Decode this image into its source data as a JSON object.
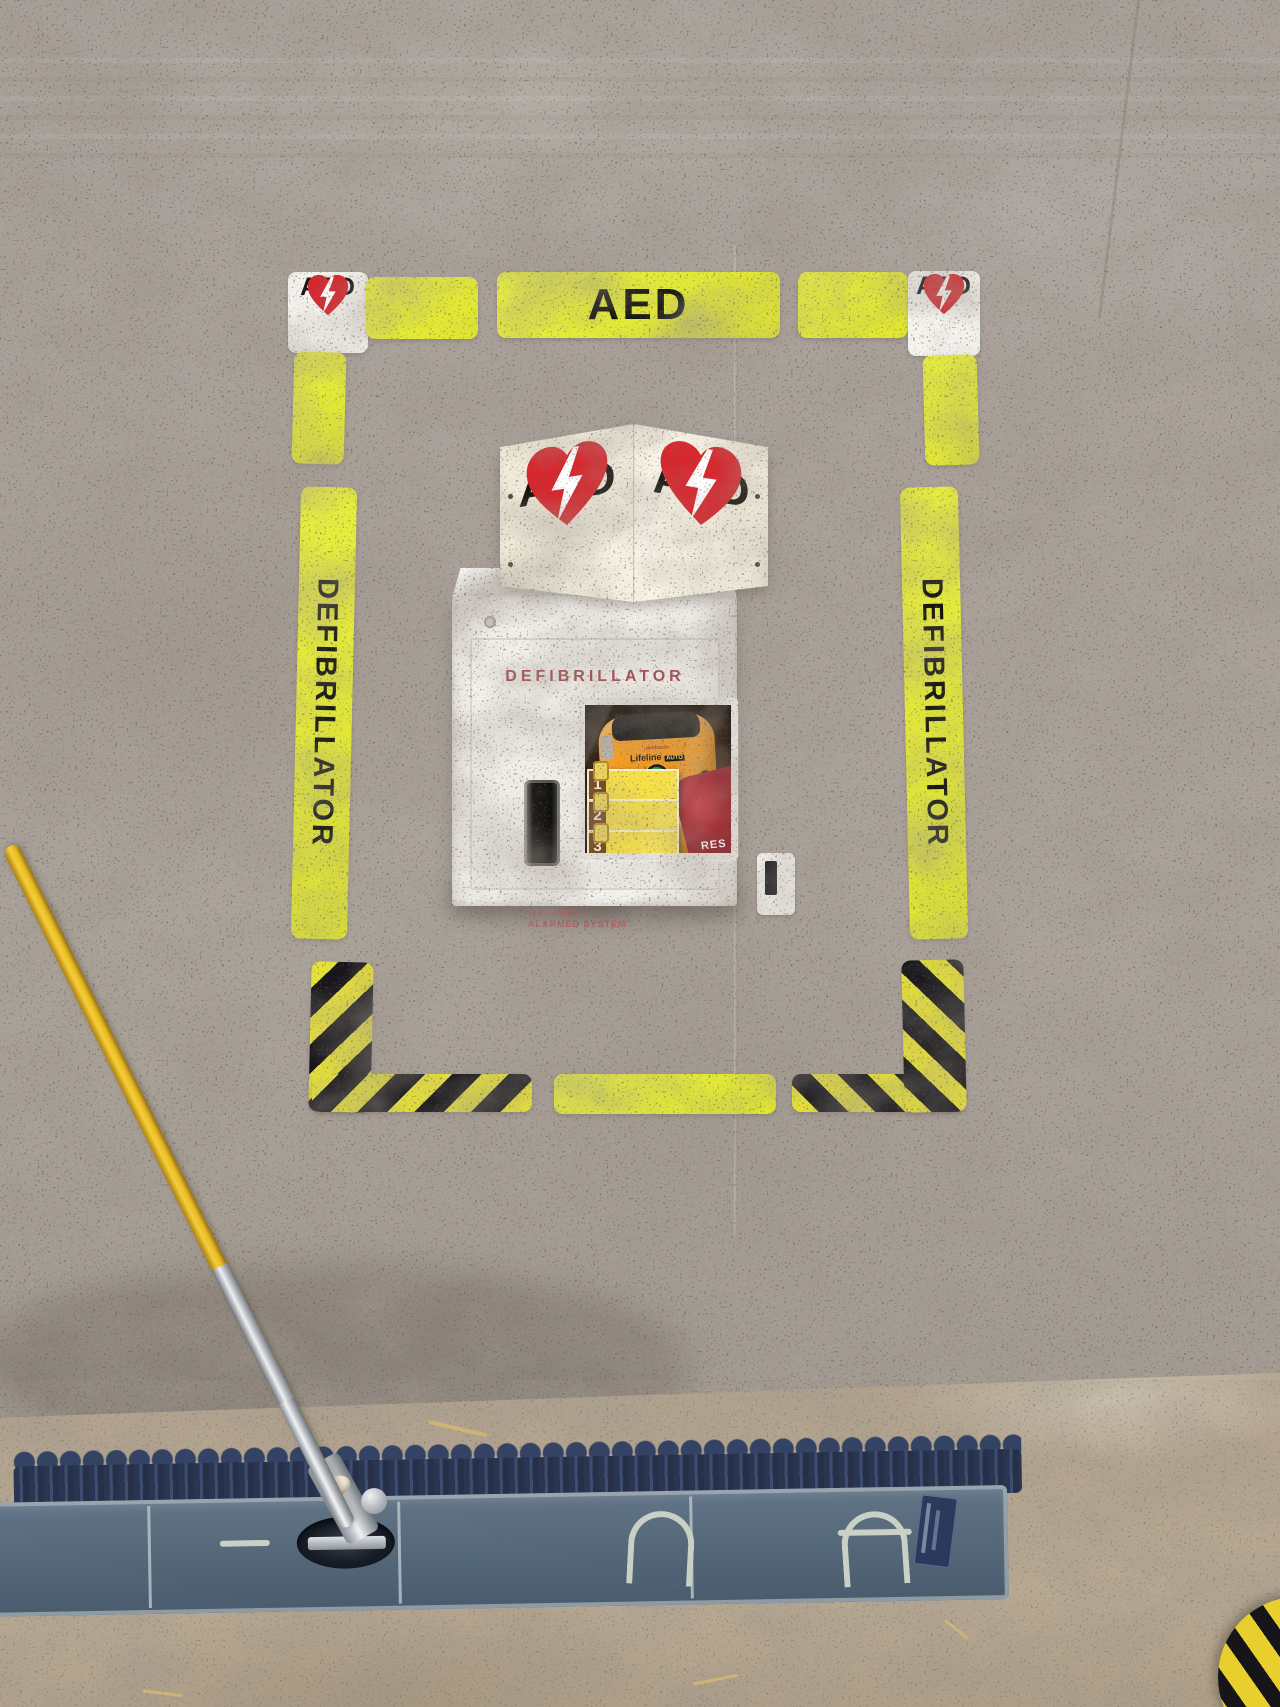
{
  "scene": {
    "description": "Wall-mounted AED defibrillator cabinet on a concrete wall, framed by yellow safety floor-marking tape, with a blue dust mop leaning across the bottom"
  },
  "frame": {
    "top_left_sign": {
      "label": "AED",
      "icon": "heart-lightning-icon"
    },
    "top_strip": {
      "label": "AED"
    },
    "top_right_sign": {
      "label": "AED",
      "icon": "heart-lightning-icon"
    },
    "left_strip": {
      "label": "DEFIBRILLATOR"
    },
    "right_strip": {
      "label": "DEFIBRILLATOR"
    }
  },
  "sign_3d": {
    "left_panel": {
      "label": "AED",
      "icon": "heart-lightning-icon"
    },
    "right_panel": {
      "label": "AED",
      "icon": "heart-lightning-icon"
    }
  },
  "cabinet": {
    "title": "DEFIBRILLATOR",
    "warning_line1": "WARNING",
    "warning_line2": "ALARMED SYSTEM",
    "device": {
      "brand": "defibtech",
      "model": "Lifeline",
      "model_badge": "AUTO",
      "steps": [
        "1",
        "2",
        "3"
      ],
      "bag_text": "RES"
    }
  },
  "colors": {
    "tape_yellow": "#e3e93b",
    "hazard_black": "#17161a",
    "heart_red": "#d7282f",
    "cabinet_title_red": "#a5494f",
    "device_orange": "#f29b1d",
    "mop_navy": "#2e3a56",
    "mop_slate": "#56697e",
    "wall_gray": "#a9a19a",
    "floor_tan": "#b3a48f",
    "handle_yellow": "#e9bb25"
  }
}
